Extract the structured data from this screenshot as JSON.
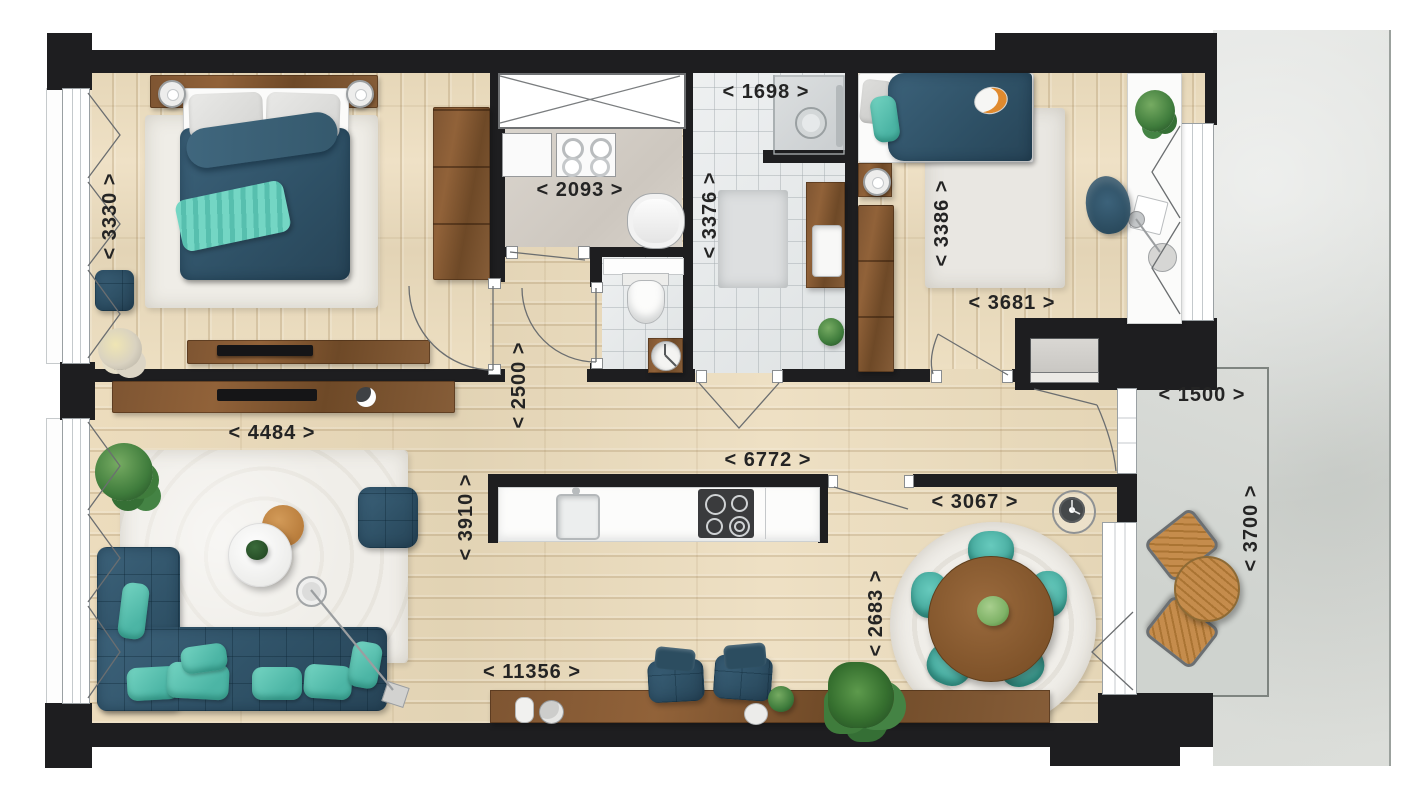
{
  "plan": {
    "type": "apartment-floorplan-top-view",
    "dimension_labels": [
      {
        "name": "dim-3330",
        "text": "< 3330 >",
        "orientation": "vertical"
      },
      {
        "name": "dim-2093",
        "text": "< 2093 >",
        "orientation": "horizontal"
      },
      {
        "name": "dim-1698",
        "text": "< 1698 >",
        "orientation": "horizontal"
      },
      {
        "name": "dim-3376",
        "text": "< 3376 >",
        "orientation": "vertical"
      },
      {
        "name": "dim-3386",
        "text": "< 3386 >",
        "orientation": "vertical"
      },
      {
        "name": "dim-3681",
        "text": "< 3681 >",
        "orientation": "horizontal"
      },
      {
        "name": "dim-2500",
        "text": "< 2500 >",
        "orientation": "vertical"
      },
      {
        "name": "dim-4484",
        "text": "< 4484 >",
        "orientation": "horizontal"
      },
      {
        "name": "dim-6772",
        "text": "< 6772 >",
        "orientation": "horizontal"
      },
      {
        "name": "dim-3910",
        "text": "< 3910 >",
        "orientation": "vertical"
      },
      {
        "name": "dim-3067",
        "text": "< 3067 >",
        "orientation": "horizontal"
      },
      {
        "name": "dim-2683",
        "text": "< 2683 >",
        "orientation": "vertical"
      },
      {
        "name": "dim-11356",
        "text": "< 11356 >",
        "orientation": "horizontal"
      },
      {
        "name": "dim-1500",
        "text": "< 1500 >",
        "orientation": "horizontal"
      },
      {
        "name": "dim-3700",
        "text": "< 3700 >",
        "orientation": "vertical"
      }
    ],
    "colors": {
      "wall": "#1e1e20",
      "wood_floor": "#e7d9bb",
      "walnut_furniture": "#7e5532",
      "oak_furniture": "#c08748",
      "dark_teal": "#33586c",
      "teal_accent": "#5fcbb9",
      "tile": "#e9ebec",
      "balcony_concrete": "#dcdeda",
      "rug": "#efede7",
      "label_text": "#242424"
    }
  }
}
